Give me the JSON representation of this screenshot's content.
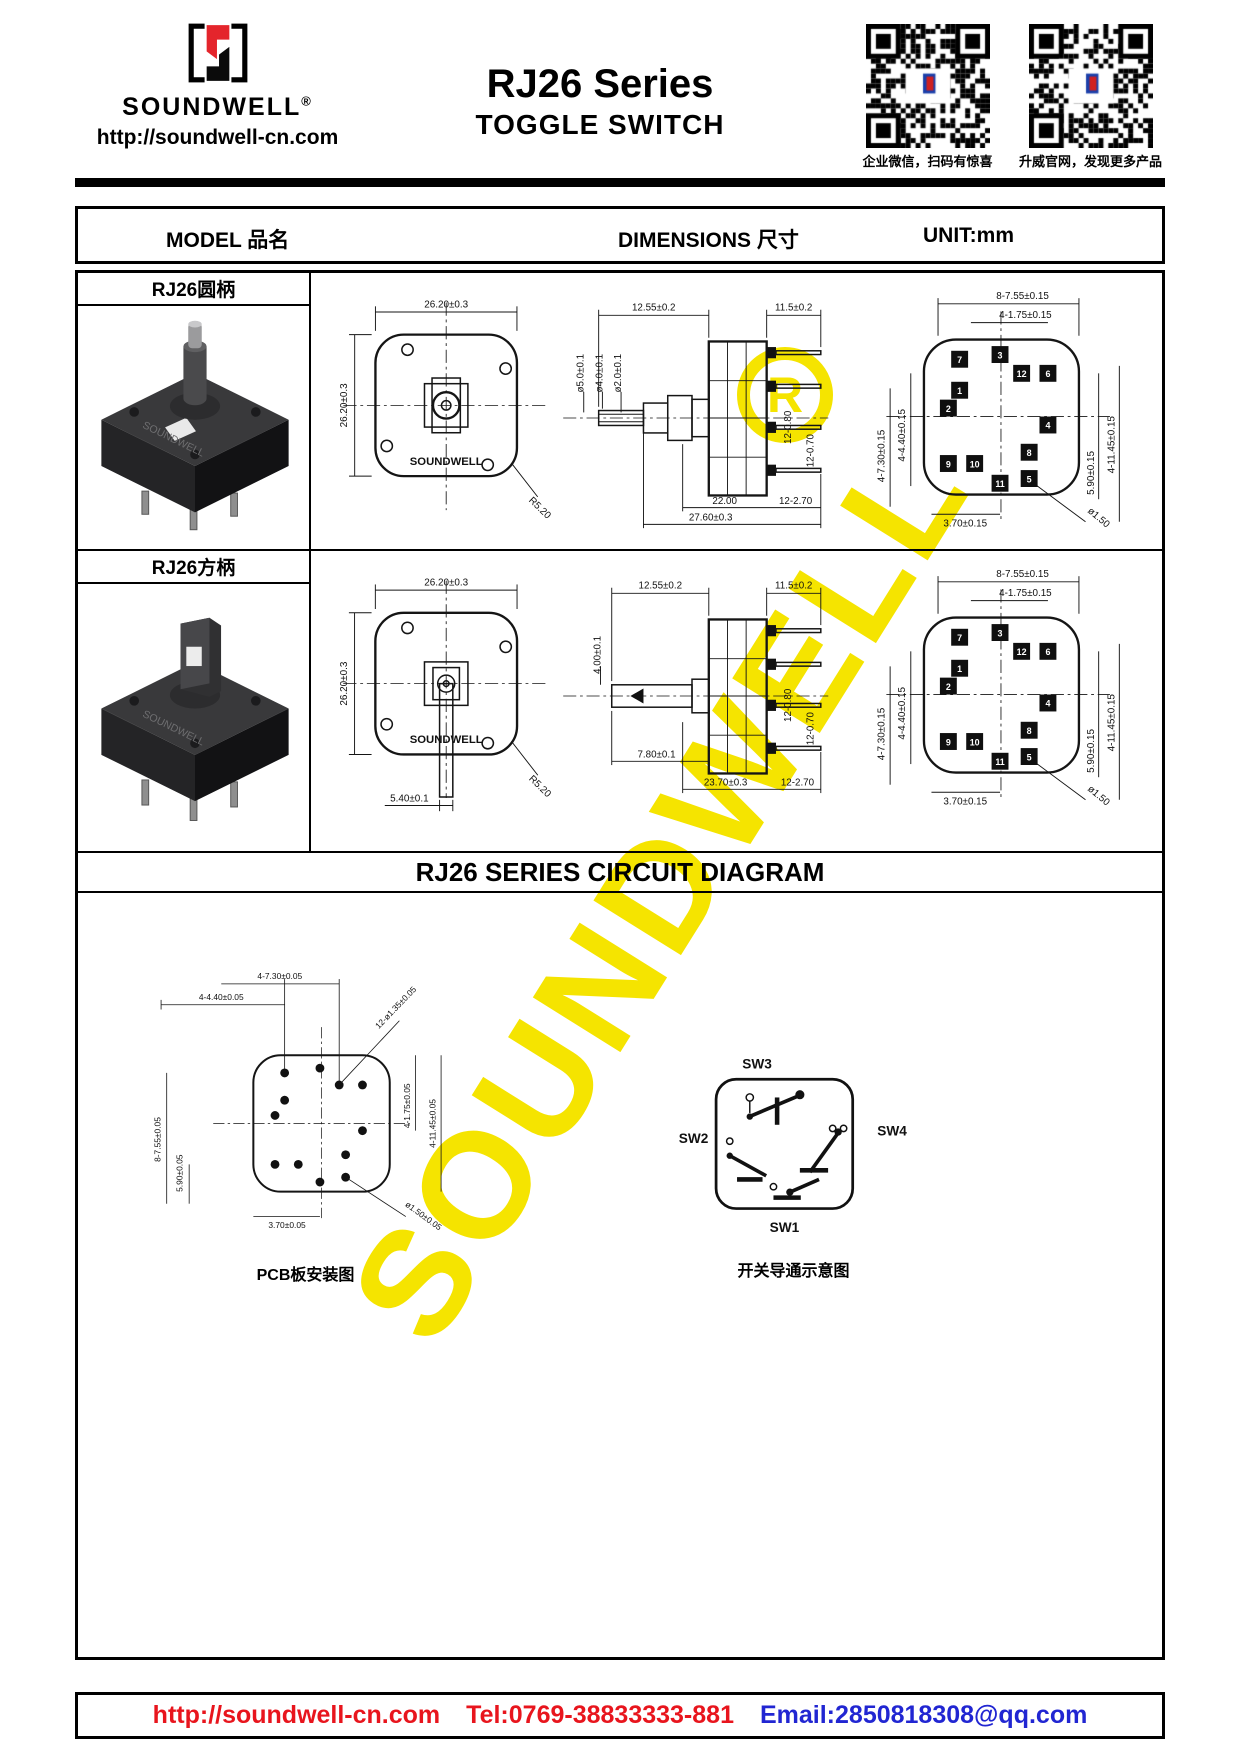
{
  "header": {
    "brand": "SOUNDWELL",
    "reg": "®",
    "url": "http://soundwell-cn.com",
    "title": "RJ26 Series",
    "subtitle": "TOGGLE SWITCH",
    "qr": {
      "left_caption": "企业微信，扫码有惊喜",
      "right_caption": "升威官网，发现更多产品"
    }
  },
  "table_header": {
    "model": "MODEL 品名",
    "dimensions": "DIMENSIONS 尺寸",
    "unit": "UNIT:mm"
  },
  "rows": [
    {
      "model": "RJ26圆柄",
      "top_view": {
        "dim_top": "26.20±0.3",
        "dim_left": "26.20±0.3",
        "radius": "R5.20",
        "brand": "SOUNDWELL"
      },
      "side_view": {
        "dim_top": "12.55±0.2",
        "shaft_d1": "ø5.0±0.1",
        "shaft_d2": "ø4.0±0.1",
        "shaft_d3": "ø2.0±0.1",
        "dim_pins_top": "11.5±0.2",
        "pin_w1": "12-0.80",
        "pin_w2": "12-0.70",
        "dim_body": "22.00",
        "dim_pitch": "12-2.70",
        "dim_total": "27.60±0.3"
      },
      "pin_view": {
        "dim_top1": "8-7.55±0.15",
        "dim_top2": "4-1.75±0.15",
        "dim_left1": "4-4.40±0.15",
        "dim_left2": "4-7.30±0.15",
        "dim_right1": "5.90±0.15",
        "dim_right2": "4-11.45±0.15",
        "dim_bottom": "3.70±0.15",
        "dim_diag": "ø1.50",
        "pins": [
          "7",
          "1",
          "3",
          "12",
          "6",
          "2",
          "4",
          "9",
          "10",
          "11",
          "8",
          "5"
        ]
      }
    },
    {
      "model": "RJ26方柄",
      "top_view": {
        "dim_top": "26.20±0.3",
        "dim_left": "26.20±0.3",
        "radius": "R5.20",
        "dim_lever": "5.40±0.1",
        "brand": "SOUNDWELL"
      },
      "side_view": {
        "dim_top": "12.55±0.2",
        "shaft_d1": "4.00±0.1",
        "shaft_d2": "7.80±0.1",
        "dim_pins_top": "11.5±0.2",
        "pin_w1": "12-0.80",
        "pin_w2": "12-0.70",
        "dim_body": "23.70±0.3",
        "dim_pitch": "12-2.70"
      },
      "pin_view": {
        "dim_top1": "8-7.55±0.15",
        "dim_top2": "4-1.75±0.15",
        "dim_left1": "4-4.40±0.15",
        "dim_left2": "4-7.30±0.15",
        "dim_right1": "5.90±0.15",
        "dim_right2": "4-11.45±0.15",
        "dim_bottom": "3.70±0.15",
        "dim_diag": "ø1.50",
        "pins": [
          "7",
          "1",
          "3",
          "12",
          "6",
          "2",
          "4",
          "9",
          "10",
          "11",
          "8",
          "5"
        ]
      }
    }
  ],
  "circuit": {
    "title": "RJ26 SERIES CIRCUIT DIAGRAM",
    "pcb": {
      "dim_top1": "4-7.30±0.05",
      "dim_top2": "4-4.40±0.05",
      "dim_diag1": "12-ø1.35±0.05",
      "dim_right1": "4-1.75±0.05",
      "dim_right2": "4-11.45±0.05",
      "dim_left1": "8-7.55±0.05",
      "dim_left2": "5.90±0.05",
      "dim_bottom": "3.70±0.05",
      "dim_diag2": "ø1.50±0.05",
      "caption": "PCB板安装图"
    },
    "sw": {
      "sw1": "SW1",
      "sw2": "SW2",
      "sw3": "SW3",
      "sw4": "SW4",
      "caption": "开关导通示意图"
    }
  },
  "footer": {
    "url": "http://soundwell-cn.com",
    "tel": "Tel:0769-38833333-881",
    "email": "Email:2850818308@qq.com"
  },
  "watermark": {
    "text": "SOUNDWELL",
    "reg": "R"
  },
  "colors": {
    "logo_red": "#e4252c",
    "footer_red": "#e8151d",
    "footer_blue": "#2126d2",
    "watermark_yellow": "#f5e400"
  }
}
